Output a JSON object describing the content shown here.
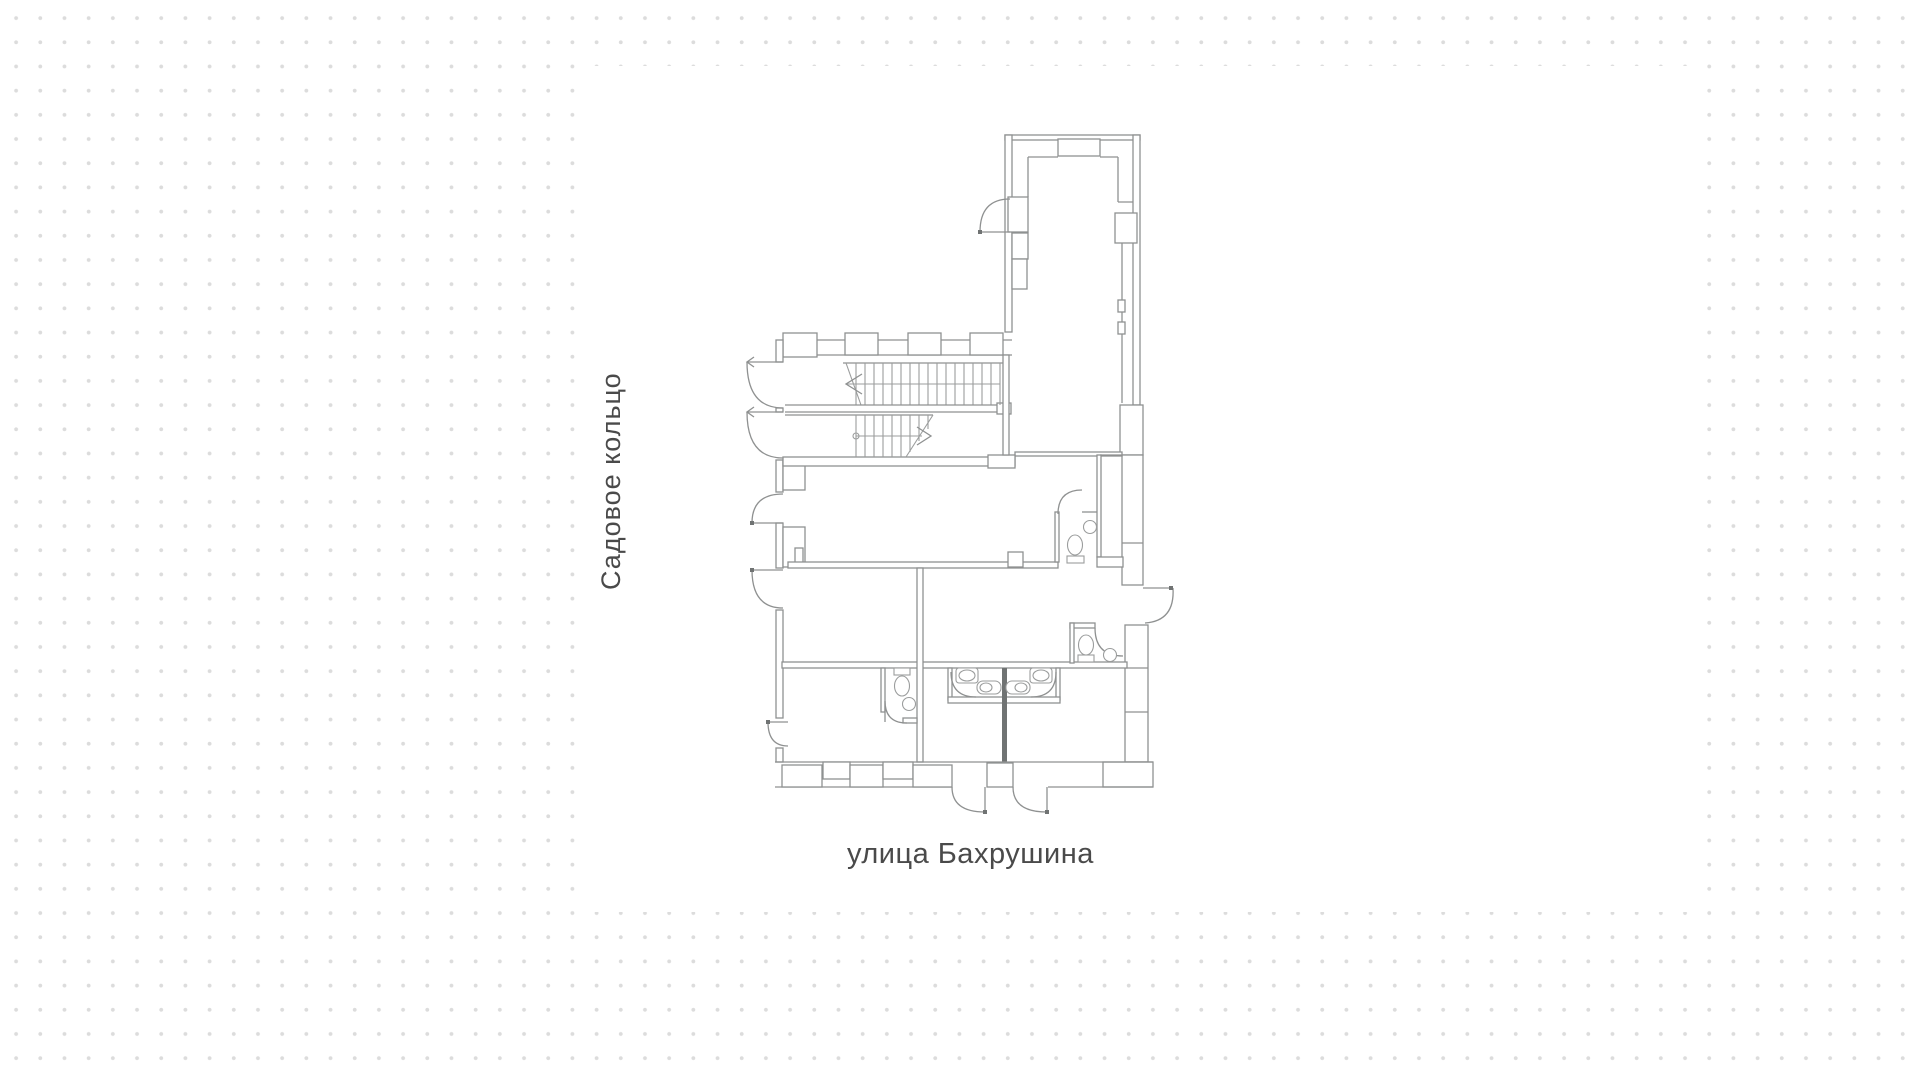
{
  "theme": {
    "canvas-bg": "#ffffff",
    "dot-color": "#dcdcdc",
    "sheet-bg": "#ffffff",
    "line-color": "#8f9191",
    "line-soft": "#9b9d9d",
    "dark-wall": "#707373",
    "label-color": "#4a4a4a"
  },
  "labels": {
    "left_street": "Садовое кольцо",
    "bottom_street": "улица Бахрушина"
  },
  "plan": {
    "type": "architectural-floor-plan",
    "visible_symbols": [
      "exterior walls with window piers",
      "double-flight staircase with direction arrows",
      "swing doors with quarter-circle arcs",
      "wc rooms with toilets and round sinks",
      "washbasin stalls with counter",
      "double entrance door on bottom street side",
      "side exit door on right wall"
    ]
  }
}
